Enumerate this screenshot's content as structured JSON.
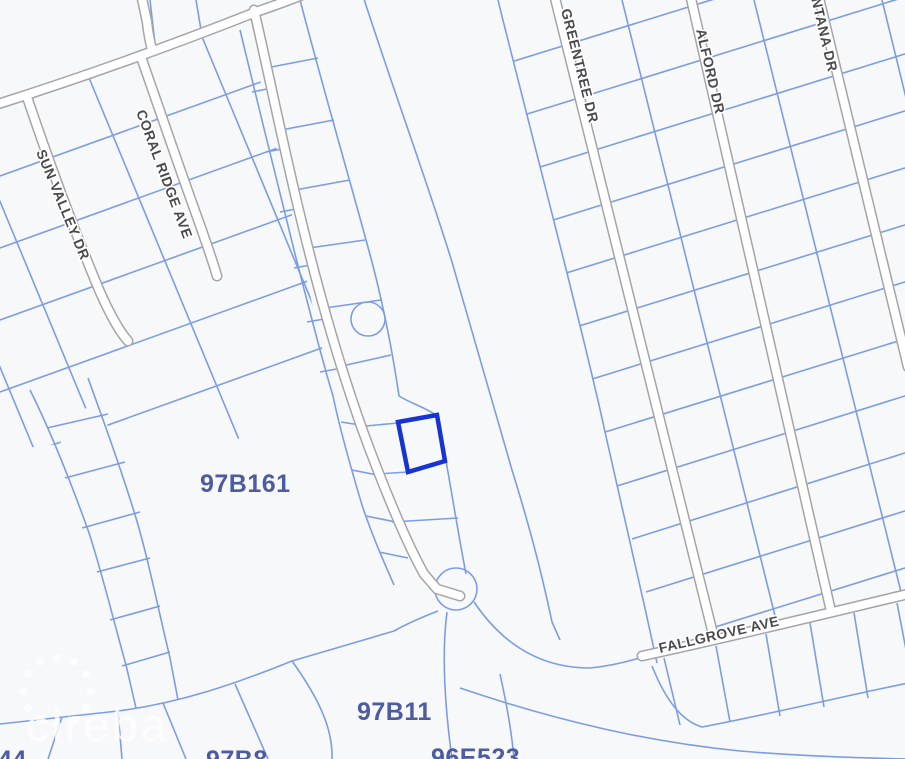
{
  "map": {
    "type": "parcel-map",
    "background_color": "#f7f8f9",
    "parcel_line_color": "#7c9de3",
    "road_fill_color": "#ffffff",
    "road_casing_color": "#a5a5a7",
    "street_label_color": "#4a4a4c",
    "parcel_label_color": "#4d5ca0",
    "streets": [
      {
        "name": "SUN VALLEY DR"
      },
      {
        "name": "CORAL RIDGE AVE"
      },
      {
        "name": "GREENTREE DR"
      },
      {
        "name": "ALFORD DR"
      },
      {
        "name": "MONTANA DR"
      },
      {
        "name": "FALLGROVE AVE"
      }
    ],
    "parcels": [
      {
        "id": "97B161"
      },
      {
        "id": "97B11"
      },
      {
        "id": "96E523"
      },
      {
        "id": "97B8"
      },
      {
        "id": "44"
      }
    ],
    "selected_parcel": {
      "outline_color": "#1733d4"
    },
    "watermark": {
      "text": "cireba"
    }
  }
}
